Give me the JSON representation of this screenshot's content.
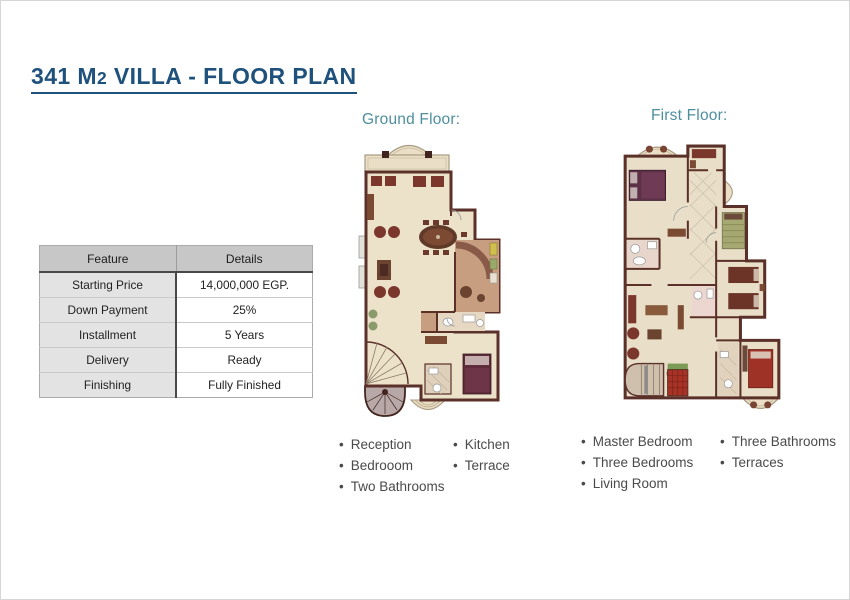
{
  "page": {
    "title_prefix": "341 M",
    "title_sub": "2",
    "title_suffix": " VILLA - FLOOR PLAN"
  },
  "table": {
    "headers": [
      "Feature",
      "Details"
    ],
    "rows": [
      [
        "Starting Price",
        "14,000,000 EGP."
      ],
      [
        "Down Payment",
        "25%"
      ],
      [
        "Installment",
        "5 Years"
      ],
      [
        "Delivery",
        "Ready"
      ],
      [
        "Finishing",
        "Fully Finished"
      ]
    ]
  },
  "ground_floor": {
    "label": "Ground Floor:",
    "features_col1": [
      "Reception",
      "Bedrooom",
      "Two Bathrooms"
    ],
    "features_col2": [
      "Kitchen",
      "Terrace"
    ]
  },
  "first_floor": {
    "label": "First Floor:",
    "features_col1": [
      "Master Bedroom",
      "Three Bedrooms",
      "Living Room"
    ],
    "features_col2": [
      "Three Bathrooms",
      "Terraces"
    ]
  },
  "colors": {
    "title_navy": "#1E527C",
    "floor_label_teal": "#4E8F9F",
    "wall_brown": "#5A3028",
    "floor_cream": "#ECE2CA",
    "terracotta": "#C79E80",
    "furniture_red": "#7C372C",
    "bed_maroon": "#5E2C3A",
    "table_header_gray": "#C7C7C7",
    "table_row_gray": "#E3E3E3"
  }
}
